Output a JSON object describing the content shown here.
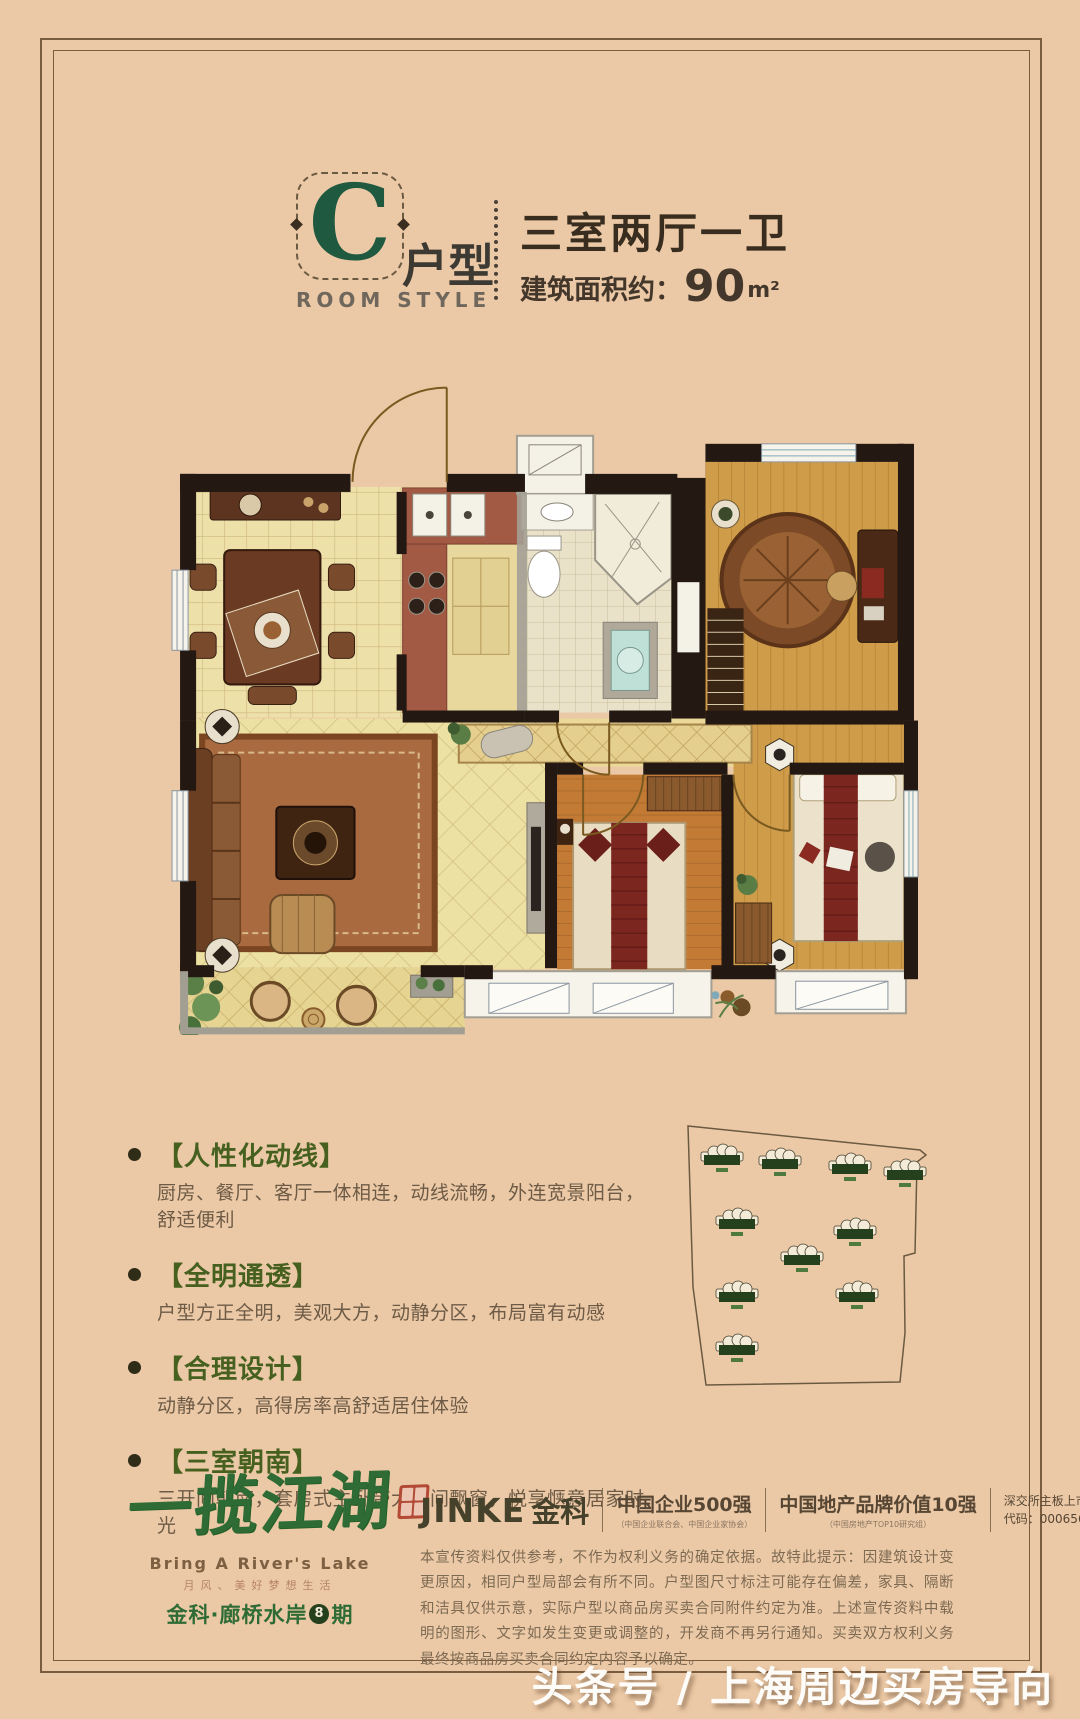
{
  "colors": {
    "background": "#ecc9a6",
    "frame": "#7a5c3e",
    "accent_green": "#2e6b35",
    "title_dark": "#392d1f",
    "feature_title_green": "#46601f"
  },
  "header": {
    "letter": "C",
    "letter_label": "户型",
    "room_style": "ROOM STYLE",
    "title": "三室两厅一卫",
    "area_label": "建筑面积约：",
    "area_value": "90",
    "area_unit": "m²"
  },
  "features": [
    {
      "title": "【人性化动线】",
      "desc": "厨房、餐厅、客厅一体相连，动线流畅，外连宽景阳台，舒适便利"
    },
    {
      "title": "【全明通透】",
      "desc": "户型方正全明，美观大方，动静分区，布局富有动感"
    },
    {
      "title": "【合理设计】",
      "desc": "动静分区，高得房率高舒适居住体验"
    },
    {
      "title": "【三室朝南】",
      "desc": "三开间朝南，套房式主卧带大开间飘窗，悦享惬意居家时光"
    }
  ],
  "site_plan": {
    "boundary": "60,26 292,50 298,55 289,62 287,153 276,156 277,233 272,282 78,285 65,187",
    "buildings": [
      [
        94,
        58
      ],
      [
        152,
        62
      ],
      [
        222,
        67
      ],
      [
        277,
        73
      ],
      [
        109,
        122
      ],
      [
        227,
        132
      ],
      [
        174,
        158
      ],
      [
        109,
        195
      ],
      [
        229,
        195
      ],
      [
        109,
        248
      ]
    ]
  },
  "brand": {
    "logo_main": "一揽江湖",
    "logo_sub_en": "Bring A River's Lake",
    "logo_tagline": "月风、美好梦想生活",
    "logo_project": "金科·廊桥水岸",
    "logo_phase_num": "8",
    "logo_phase_suffix": "期",
    "jinke_en": "JINKE",
    "jinke_cn": "金科",
    "honor1": "中国企业500强",
    "honor1_sub": "（中国企业联合会、中国企业家协会）",
    "honor2": "中国地产品牌价值10强",
    "honor2_sub": "（中国房地产TOP10研究组）",
    "listing_line1": "深交所主板上市",
    "listing_line2": "代码：000656"
  },
  "disclaimer": "本宣传资料仅供参考，不作为权利义务的确定依据。故特此提示：因建筑设计变更原因，相同户型局部会有所不同。户型图尺寸标注可能存在偏差，家具、隔断和洁具仅供示意，实际户型以商品房买卖合同附件约定为准。上述宣传资料中载明的图形、文字如发生变更或调整的，开发商不再另行通知。买卖双方权利义务最终按商品房买卖合同约定内容予以确定。",
  "watermark": "头条号 / 上海周边买房导向"
}
